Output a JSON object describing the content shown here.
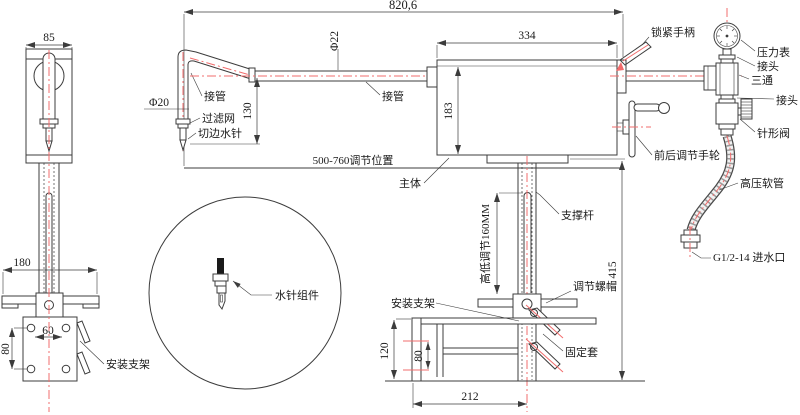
{
  "drawing": {
    "dims": {
      "overall_width": "820,6",
      "front_width": "85",
      "pipe_dia_bent": "Φ20",
      "pipe_dia_main": "Φ22",
      "needle_drop": "130",
      "body_width": "334",
      "body_height": "183",
      "adjust_range": "500-760调节位置",
      "height_adjust": "高低调节160MM",
      "overall_height": "415",
      "bracket_width": "180",
      "hole_span_h": "60",
      "hole_span_v": "80",
      "side_height": "120",
      "side_hole_span": "80",
      "side_depth": "212"
    },
    "labels": {
      "lock_handle": "锁紧手柄",
      "pressure_gauge": "压力表",
      "adapter_top": "接头",
      "tee": "三通",
      "adapter_bottom": "接头",
      "needle_valve": "针形阀",
      "fb_handwheel": "前后调节手轮",
      "hp_hose": "高压软管",
      "water_inlet": "G1/2-14 进水口",
      "pipe_bent": "接管",
      "pipe_main": "接管",
      "filter": "过滤网",
      "trim_needle": "切边水针",
      "main_body": "主体",
      "support_rod": "支撑杆",
      "adjust_nut": "调节螺帽",
      "fixing_sleeve": "固定套",
      "mount_bracket_front": "安装支架",
      "mount_bracket_side": "安装支架",
      "needle_assembly": "水针组件"
    },
    "colors": {
      "line": "#3c3c3c",
      "centerline": "#f26c6c"
    }
  }
}
